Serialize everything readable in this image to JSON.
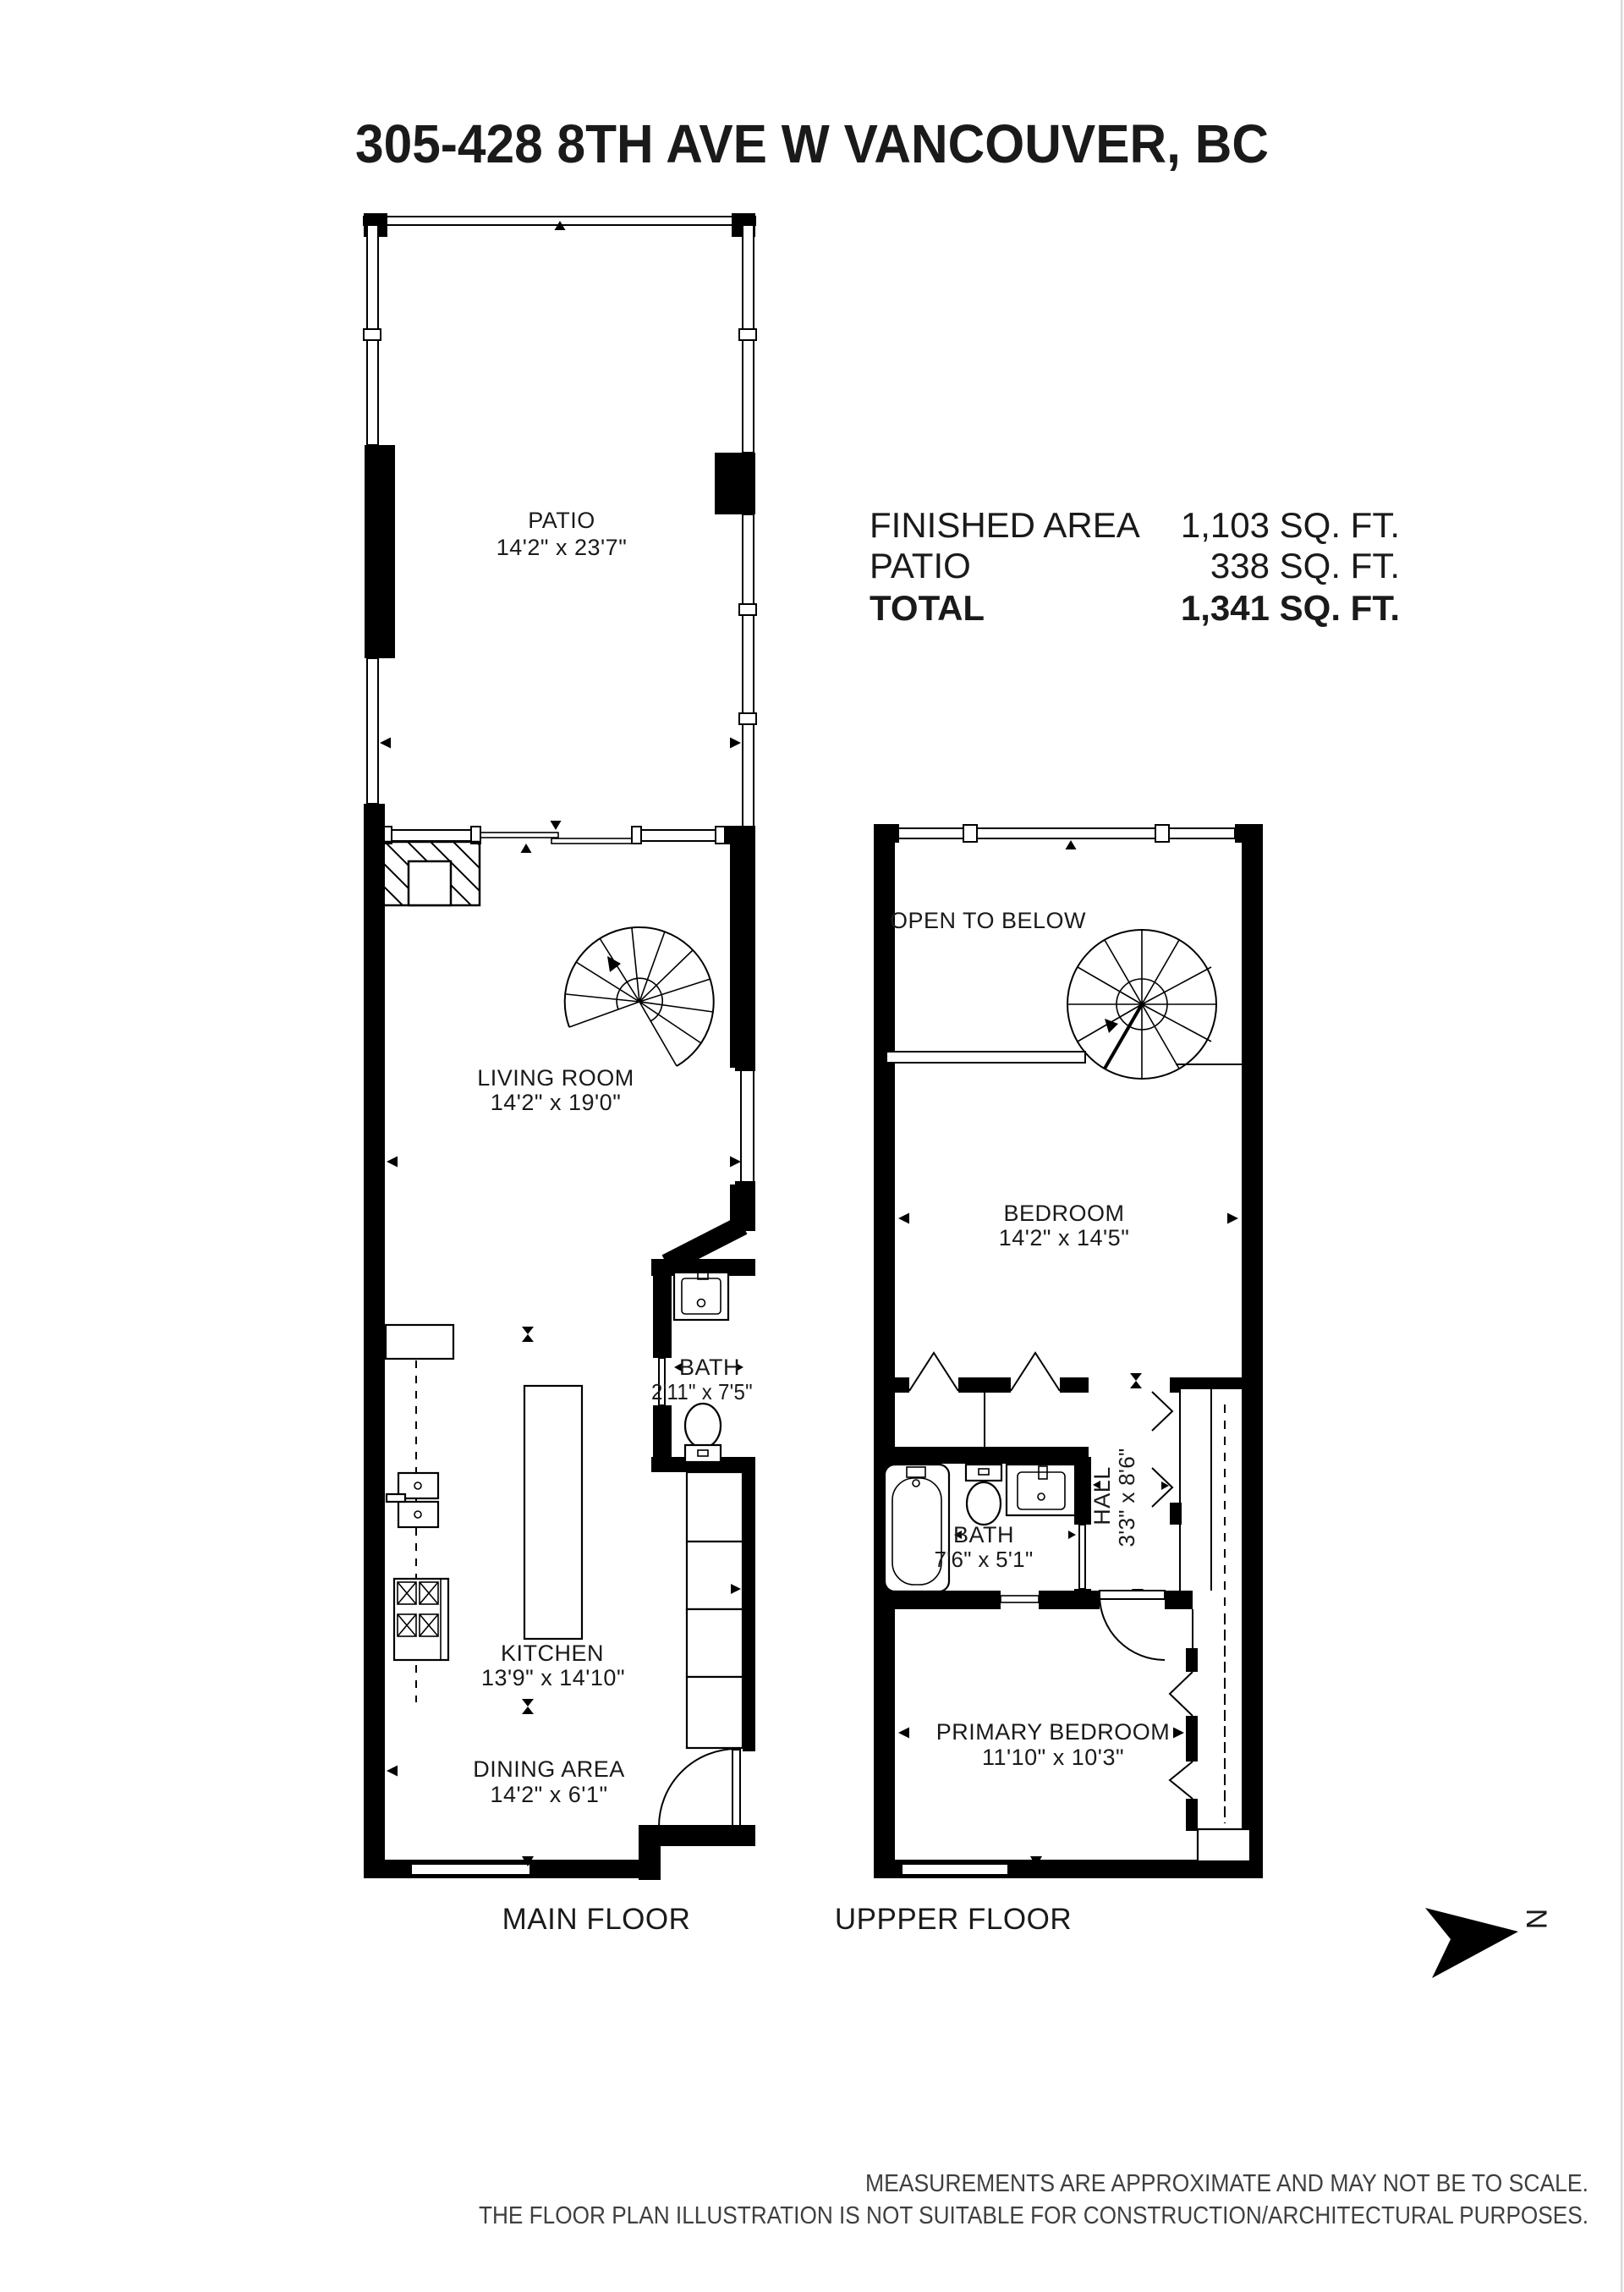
{
  "title": "305-428 8TH AVE W VANCOUVER, BC",
  "summary": {
    "rows": [
      {
        "label": "FINISHED AREA",
        "value": "1,103 SQ. FT."
      },
      {
        "label": "PATIO",
        "value": "338 SQ. FT."
      },
      {
        "label": "TOTAL",
        "value": "1,341 SQ. FT."
      }
    ]
  },
  "main": {
    "floor_label": "MAIN FLOOR",
    "patio": {
      "name": "PATIO",
      "dims": "14'2\" x 23'7\""
    },
    "living": {
      "name": "LIVING ROOM",
      "dims": "14'2\" x 19'0\""
    },
    "bath": {
      "name": "BATH",
      "dims": "2'11\" x 7'5\""
    },
    "kitchen": {
      "name": "KITCHEN",
      "dims": "13'9\" x 14'10\""
    },
    "dining": {
      "name": "DINING AREA",
      "dims": "14'2\" x 6'1\""
    }
  },
  "upper": {
    "floor_label": "UPPPER FLOOR",
    "open_below": "OPEN TO BELOW",
    "bedroom": {
      "name": "BEDROOM",
      "dims": "14'2\" x 14'5\""
    },
    "bath": {
      "name": "BATH",
      "dims": "7'6\" x 5'1\""
    },
    "hall": {
      "name": "HALL",
      "dims": "3'3\" x 8'6\""
    },
    "primary": {
      "name": "PRIMARY BEDROOM",
      "dims": "11'10\" x 10'3\""
    }
  },
  "compass": {
    "north_label": "N"
  },
  "disclaimer": {
    "line1": "MEASUREMENTS ARE APPROXIMATE AND MAY NOT BE TO SCALE.",
    "line2": "THE FLOOR PLAN ILLUSTRATION IS NOT SUITABLE FOR CONSTRUCTION/ARCHITECTURAL PURPOSES."
  }
}
